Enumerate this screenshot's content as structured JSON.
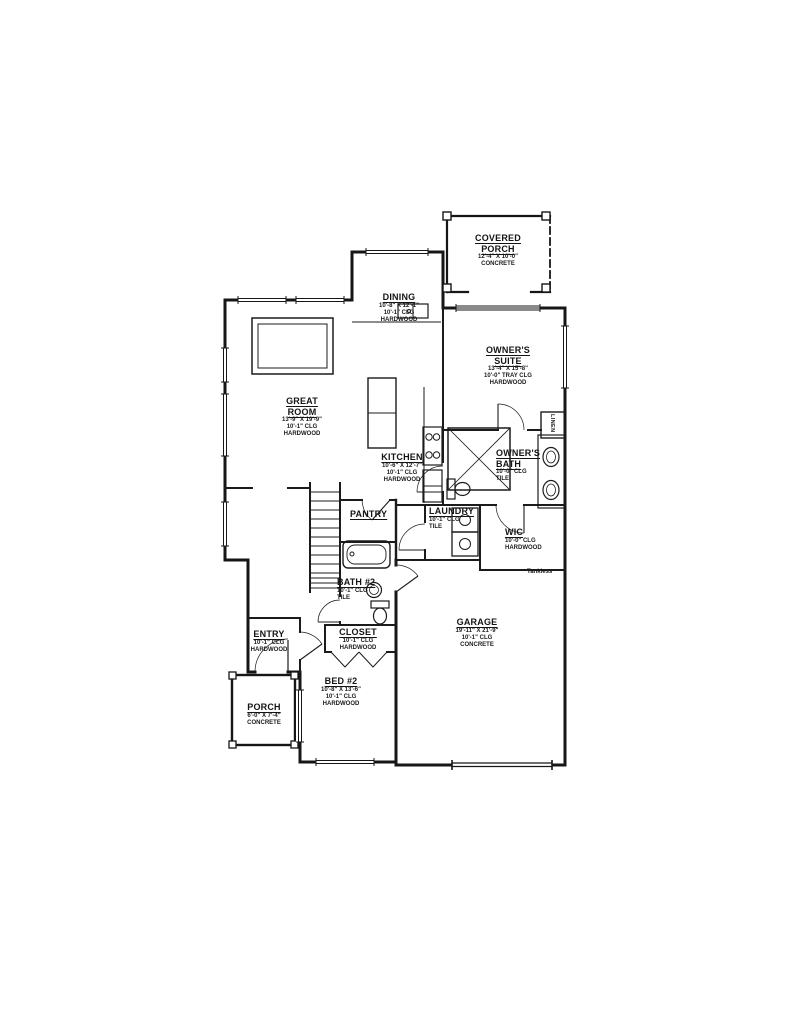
{
  "page": {
    "background": "#ffffff",
    "ink": "#161616"
  },
  "rooms": {
    "covered_porch": {
      "name": "COVERED PORCH",
      "dims": "12'-4\" X 10'-0\"",
      "surface": "CONCRETE"
    },
    "dining": {
      "name": "DINING",
      "dims": "10'-8\" X 12'-1\"",
      "ceiling": "10'-1\" CLG",
      "surface": "HARDWOOD"
    },
    "owners_suite": {
      "name": "OWNER'S SUITE",
      "dims": "13'-4\" X 15'-8\"",
      "ceiling": "10'-0\" TRAY CLG",
      "surface": "HARDWOOD"
    },
    "great_room": {
      "name": "GREAT ROOM",
      "dims": "13'-9\" X 19'-9\"",
      "ceiling": "10'-1\" CLG",
      "surface": "HARDWOOD"
    },
    "kitchen": {
      "name": "KITCHEN",
      "dims": "10'-6\" X 12'-7\"",
      "ceiling": "10'-1\" CLG",
      "surface": "HARDWOOD"
    },
    "owners_bath": {
      "name": "OWNER'S BATH",
      "ceiling": "10'-0\" CLG",
      "surface": "TILE"
    },
    "pantry": {
      "name": "PANTRY"
    },
    "laundry": {
      "name": "LAUNDRY",
      "ceiling": "10'-1\" CLG",
      "surface": "TILE"
    },
    "wic": {
      "name": "WIC",
      "ceiling": "10'-0\" CLG",
      "surface": "HARDWOOD"
    },
    "bath_2": {
      "name": "BATH #2",
      "ceiling": "10'-1\" CLG",
      "surface": "TILE"
    },
    "closet": {
      "name": "CLOSET",
      "ceiling": "10'-1\" CLG",
      "surface": "HARDWOOD"
    },
    "entry": {
      "name": "ENTRY",
      "ceiling": "10'-1\" CLG",
      "surface": "HARDWOOD"
    },
    "bed_2": {
      "name": "BED #2",
      "dims": "10'-8\" X 13'-6\"",
      "ceiling": "10'-1\" CLG",
      "surface": "HARDWOOD"
    },
    "porch": {
      "name": "PORCH",
      "dims": "6'-0\" X 7'-4\"",
      "surface": "CONCRETE"
    },
    "garage": {
      "name": "GARAGE",
      "dims": "19'-11\" X 21'-9\"",
      "ceiling": "10'-1\" CLG",
      "surface": "CONCRETE"
    }
  },
  "annotations": {
    "tankless": "Tankless",
    "linen": "LINEN"
  }
}
